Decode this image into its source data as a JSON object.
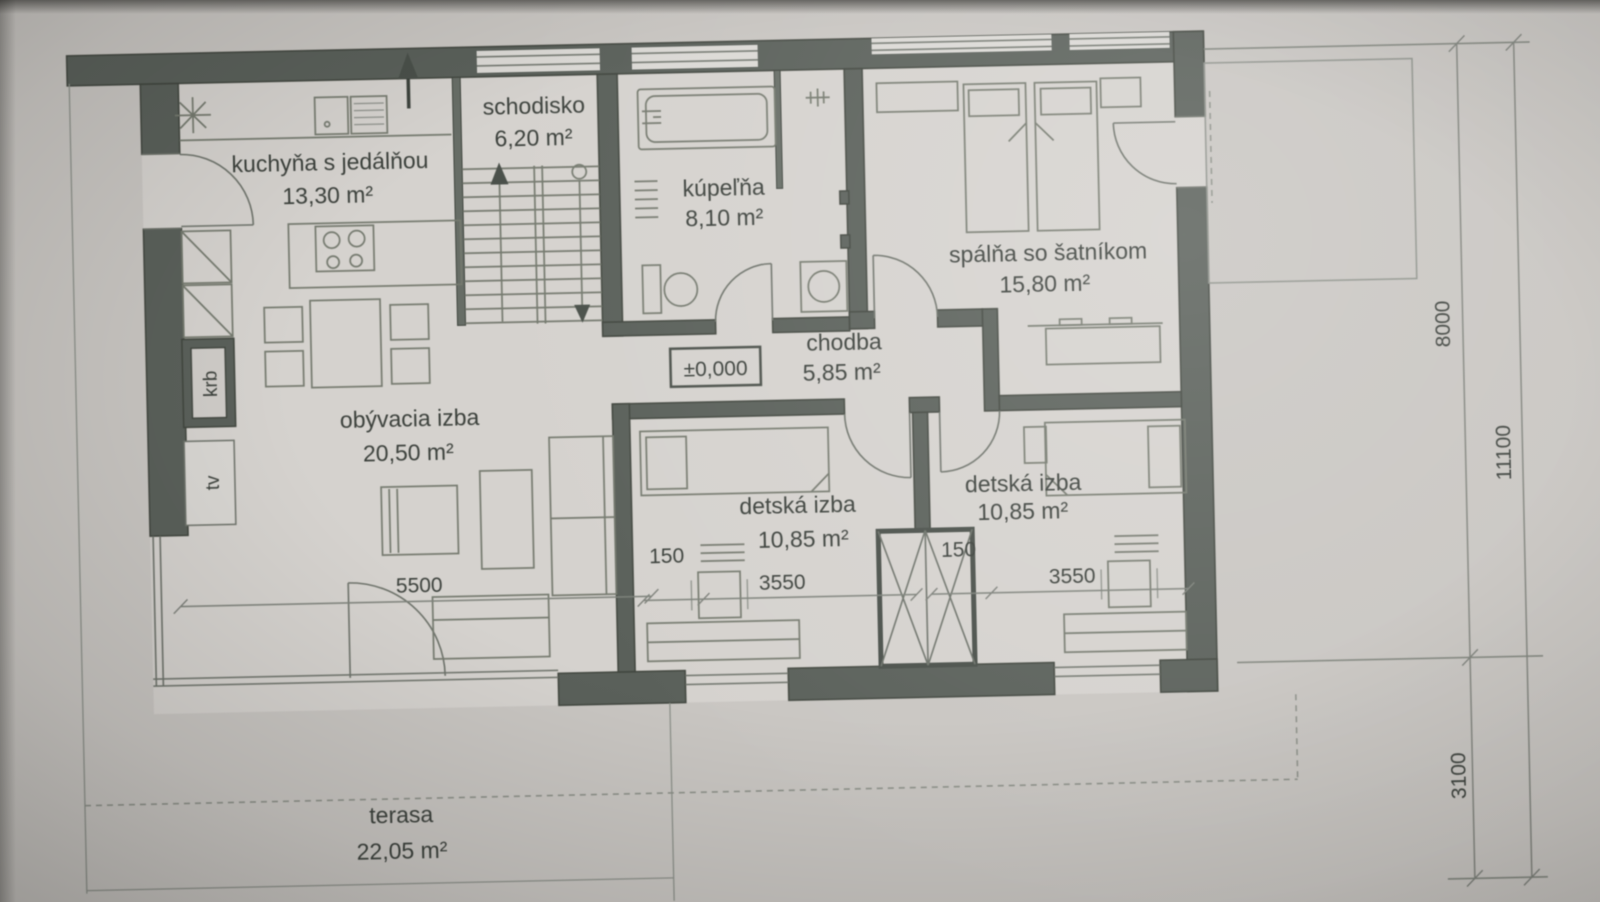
{
  "rooms": {
    "kitchen": {
      "name": "kuchyňa s jedálňou",
      "area": "13,30 m²"
    },
    "staircase": {
      "name": "schodisko",
      "area": "6,20 m²"
    },
    "bathroom": {
      "name": "kúpeľňa",
      "area": "8,10 m²"
    },
    "bedroom": {
      "name": "spálňa so šatníkom",
      "area": "15,80 m²"
    },
    "hallway": {
      "name": "chodba",
      "area": "5,85 m²"
    },
    "living_room": {
      "name": "obývacia izba",
      "area": "20,50 m²"
    },
    "kids_room_1": {
      "name": "detská izba",
      "area": "10,85 m²"
    },
    "kids_room_2": {
      "name": "detská izba",
      "area": "10,85 m²"
    },
    "terrace": {
      "name": "terasa",
      "area": "22,05 m²"
    }
  },
  "labels": {
    "fireplace": "krb",
    "tv": "tv",
    "floor_level": "±0,000"
  },
  "dimensions": {
    "living_room_width": "5500",
    "kids_room_1": {
      "offset": "150",
      "width": "3550"
    },
    "kids_room_2": {
      "offset": "150",
      "width": "3550"
    },
    "house_depth": "8000",
    "total_depth": "11100",
    "terrace_depth": "3100"
  },
  "colors": {
    "wall": "#5a605a",
    "paper": "#c9c6c2",
    "floor": "#d5d2ce",
    "text": "#3c413c"
  }
}
